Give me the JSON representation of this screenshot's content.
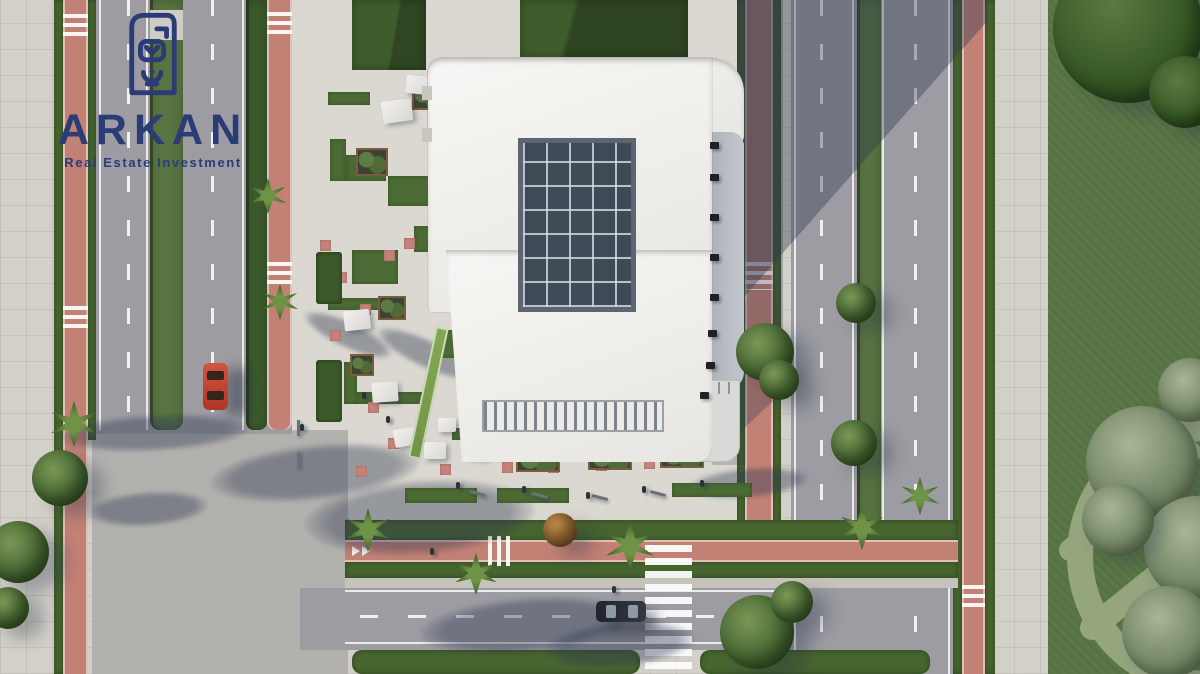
{
  "branding": {
    "name": "ARKAN",
    "tagline": "Real Estate Investment",
    "brand_color": "#2b3b76",
    "logo_mark": "arkan-emblem-icon"
  },
  "scene": {
    "type": "aerial-architectural-render",
    "view": "top-down",
    "description": "Top-down 3D architectural rendering of a white commercial building with a central glass skylight and louvered entrance canopy, surrounded by a paved plaza with grass patches, planters and umbrellas, boulevards with pink cycle lanes, zebra crosswalks, a red car and a dark car, palm trees, hedges, and a large lawn with a mowed Arkan emblem watermark",
    "palette": {
      "building_white": "#f0efed",
      "skylight_glass": "#3f4a57",
      "paver_light": "#d3d0c9",
      "asphalt_road": "#9c9ca2",
      "cycle_lane_pink": "#c28175",
      "hedge_green": "#47652f",
      "lawn_green": "#5b7747",
      "watermark_green": "#9cab84",
      "red_car": "#c0392b",
      "dark_car": "#23262c"
    },
    "objects": [
      "building-roof",
      "skylight",
      "entrance-canopy",
      "balcony-walkway",
      "roof-terrace",
      "plaza-pavement",
      "grass-patches",
      "planters",
      "umbrella-canopies",
      "benches",
      "pedestrians",
      "cycle-lane-left",
      "cycle-lane-right",
      "cycle-lane-bottom",
      "boulevard-left",
      "boulevard-right",
      "road-bottom",
      "crosswalks",
      "median-strips",
      "palm-trees",
      "trees",
      "red-car",
      "dark-car",
      "lawn",
      "lawn-emblem-watermark",
      "building-shadow",
      "tree-shadows"
    ]
  }
}
